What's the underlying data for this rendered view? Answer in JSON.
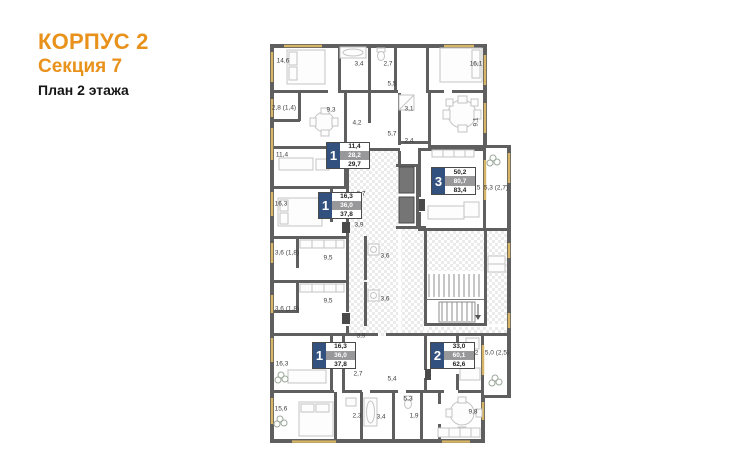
{
  "header": {
    "building": "КОРПУС 2",
    "section": "Секция 7",
    "floor": "План 2 этажа"
  },
  "colors": {
    "accent_orange": "#E8921C",
    "wall_gray": "#5F5F5F",
    "window_yellow": "#D7B566",
    "apartment_box_blue": "#33517E",
    "apartment_box_gray": "#98989A"
  },
  "apartments": [
    {
      "number": "1",
      "living_area": "11,4",
      "area": "28,2",
      "total_area": "29,7"
    },
    {
      "number": "1",
      "living_area": "16,3",
      "area": "36,0",
      "total_area": "37,8"
    },
    {
      "number": "3",
      "living_area": "50,2",
      "area": "80,7",
      "total_area": "83,4"
    },
    {
      "number": "1",
      "living_area": "16,3",
      "area": "36,0",
      "total_area": "37,8"
    },
    {
      "number": "2",
      "living_area": "33,0",
      "area": "60,1",
      "total_area": "62,6"
    }
  ],
  "room_labels": [
    {
      "text": "14,6",
      "x": 283,
      "y": 61
    },
    {
      "text": "3,4",
      "x": 359,
      "y": 64
    },
    {
      "text": "2,7",
      "x": 388,
      "y": 64
    },
    {
      "text": "16,1",
      "x": 476,
      "y": 64
    },
    {
      "text": "5,5",
      "x": 392,
      "y": 84
    },
    {
      "text": "2,8 (1,4)",
      "x": 284,
      "y": 108
    },
    {
      "text": "9,3",
      "x": 331,
      "y": 110
    },
    {
      "text": "3,1",
      "x": 409,
      "y": 109
    },
    {
      "text": "4,2",
      "x": 357,
      "y": 123
    },
    {
      "text": "9,1",
      "x": 476,
      "y": 122,
      "rot": true
    },
    {
      "text": "5,7",
      "x": 392,
      "y": 134
    },
    {
      "text": "2,4",
      "x": 409,
      "y": 141
    },
    {
      "text": "11,4",
      "x": 282,
      "y": 155
    },
    {
      "text": "4,3",
      "x": 357,
      "y": 153
    },
    {
      "text": "19,5",
      "x": 474,
      "y": 188
    },
    {
      "text": "5,3 (2,7)",
      "x": 496,
      "y": 188
    },
    {
      "text": "16,3",
      "x": 281,
      "y": 204
    },
    {
      "text": "2,7",
      "x": 361,
      "y": 194
    },
    {
      "text": "3,9",
      "x": 359,
      "y": 225
    },
    {
      "text": "3,6 (1,8)",
      "x": 287,
      "y": 253
    },
    {
      "text": "9,5",
      "x": 328,
      "y": 258
    },
    {
      "text": "3,6",
      "x": 385,
      "y": 256
    },
    {
      "text": "3,6 (1,8)",
      "x": 287,
      "y": 309
    },
    {
      "text": "9,5",
      "x": 328,
      "y": 301
    },
    {
      "text": "3,6",
      "x": 385,
      "y": 299
    },
    {
      "text": "3,9",
      "x": 361,
      "y": 336
    },
    {
      "text": "16,3",
      "x": 282,
      "y": 364
    },
    {
      "text": "2,7",
      "x": 358,
      "y": 374
    },
    {
      "text": "5,4",
      "x": 392,
      "y": 379
    },
    {
      "text": "14,2",
      "x": 472,
      "y": 353
    },
    {
      "text": "5,0 (2,5)",
      "x": 497,
      "y": 353
    },
    {
      "text": "5,3",
      "x": 408,
      "y": 399
    },
    {
      "text": "15,6",
      "x": 281,
      "y": 409
    },
    {
      "text": "2,3",
      "x": 357,
      "y": 416
    },
    {
      "text": "3,4",
      "x": 381,
      "y": 417
    },
    {
      "text": "1,9",
      "x": 414,
      "y": 416
    },
    {
      "text": "9,8",
      "x": 473,
      "y": 412
    }
  ]
}
